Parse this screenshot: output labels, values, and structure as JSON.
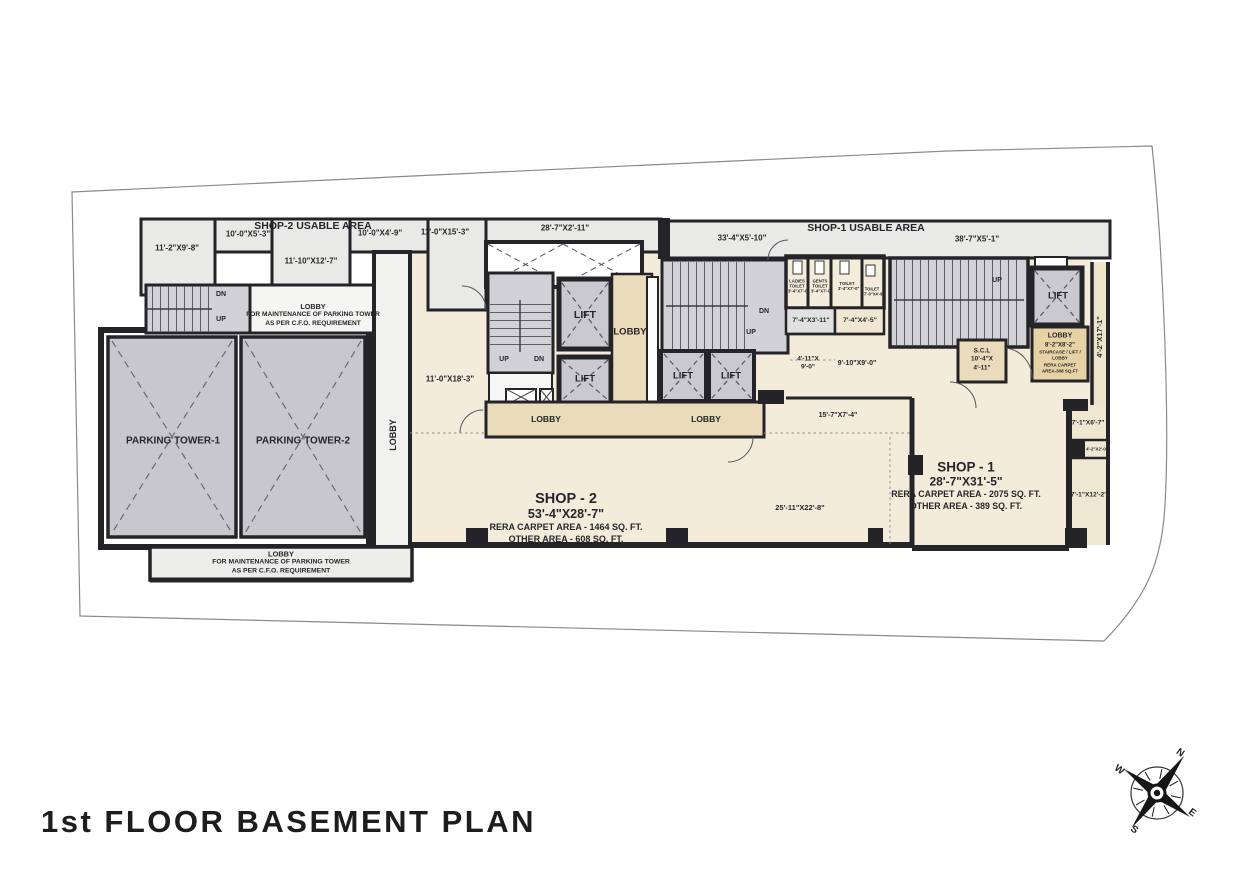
{
  "title": "1st FLOOR BASEMENT PLAN",
  "bands": {
    "shop2": {
      "title": "SHOP-2 USABLE AREA",
      "d1": "11'-2\"X9'-8\"",
      "d2": "10'-0\"X5'-3\"",
      "d3": "10'-0\"X4'-9\"",
      "d4": "11'-0\"X15'-3\"",
      "d5": "11'-10\"X12'-7\"",
      "d6": "28'-7\"X2'-11\""
    },
    "shop1": {
      "title": "SHOP-1 USABLE AREA",
      "d1": "33'-4\"X5'-10\"",
      "d2": "38'-7\"X5'-1\""
    }
  },
  "parking": {
    "tower1": "PARKING TOWER-1",
    "tower2": "PARKING TOWER-2",
    "corridor_lobby": "LOBBY",
    "dn": "DN",
    "up": "UP",
    "maint_top": {
      "l1": "LOBBY",
      "l2": "FOR MAINTENANCE OF PARKING TOWER",
      "l3": "AS PER C.F.O. REQUIREMENT"
    },
    "maint_bottom": {
      "l1": "LOBBY",
      "l2": "FOR MAINTENANCE OF PARKING TOWER",
      "l3": "AS PER C.F.O. REQUIREMENT"
    }
  },
  "core1": {
    "dim": "11'-0\"X18'-3\"",
    "up": "UP",
    "dn": "DN",
    "lift1": "LIFT",
    "lift2": "LIFT",
    "lobby": "LOBBY",
    "lobby_strip1": "LOBBY",
    "lobby_strip2": "LOBBY"
  },
  "core2": {
    "dn": "DN",
    "up": "UP",
    "lift1": "LIFT",
    "lift2": "LIFT"
  },
  "toilets": {
    "t1_name": "LADIES TOILET",
    "t1_size": "3'-4\"X7'-0\"",
    "t2_name": "GENTS TOILET",
    "t2_size": "3'-4\"X7'-0\"",
    "t3_name": "TOILET",
    "t3_size": "3'-4\"X7'-0\"",
    "t4_name": "TOILET",
    "t4_size": "7'-0\"X4'-9\"",
    "room1": "7'-4\"X3'-11\"",
    "room2": "7'-4\"X4'-5\"",
    "pass1a": "4'-11\"X",
    "pass1b": "9'-0\"",
    "pass2": "9'-10\"X9'-0\"",
    "pass3": "15'-7\"X7'-4\""
  },
  "core3": {
    "up": "UP",
    "lift": "LIFT",
    "scl1": "S.C.L",
    "scl2": "10'-4\"X",
    "scl3": "4'-11\"",
    "lobby": "LOBBY",
    "lobby_size": "8'-2\"X8'-2\"",
    "note1": "STAIRCASE / LIFT /",
    "note2": "LOBBY",
    "note3": "RERA CARPET",
    "note4": "AREA-308 SQ.FT",
    "side_dim": "4'-2\"X17'-1\""
  },
  "shop2": {
    "name": "SHOP - 2",
    "size": "53'-4\"X28'-7\"",
    "rera": "RERA CARPET AREA - 1464 SQ. FT.",
    "other": "OTHER AREA - 608 SQ. FT."
  },
  "shop1": {
    "name": "SHOP - 1",
    "size": "28'-7\"X31'-5\"",
    "rera": "RERA CARPET AREA - 2075 SQ. FT.",
    "other": "OTHER AREA - 389 SQ. FT.",
    "dim": "25'-11\"X22'-8\""
  },
  "right_rooms": {
    "r1": "7'-1\"X6'-7\"",
    "r2": "4'-2\"X2'-0\"",
    "r3": "7'-1\"X12'-2\""
  },
  "compass": {
    "n": "N",
    "e": "E",
    "s": "S",
    "w": "W"
  }
}
